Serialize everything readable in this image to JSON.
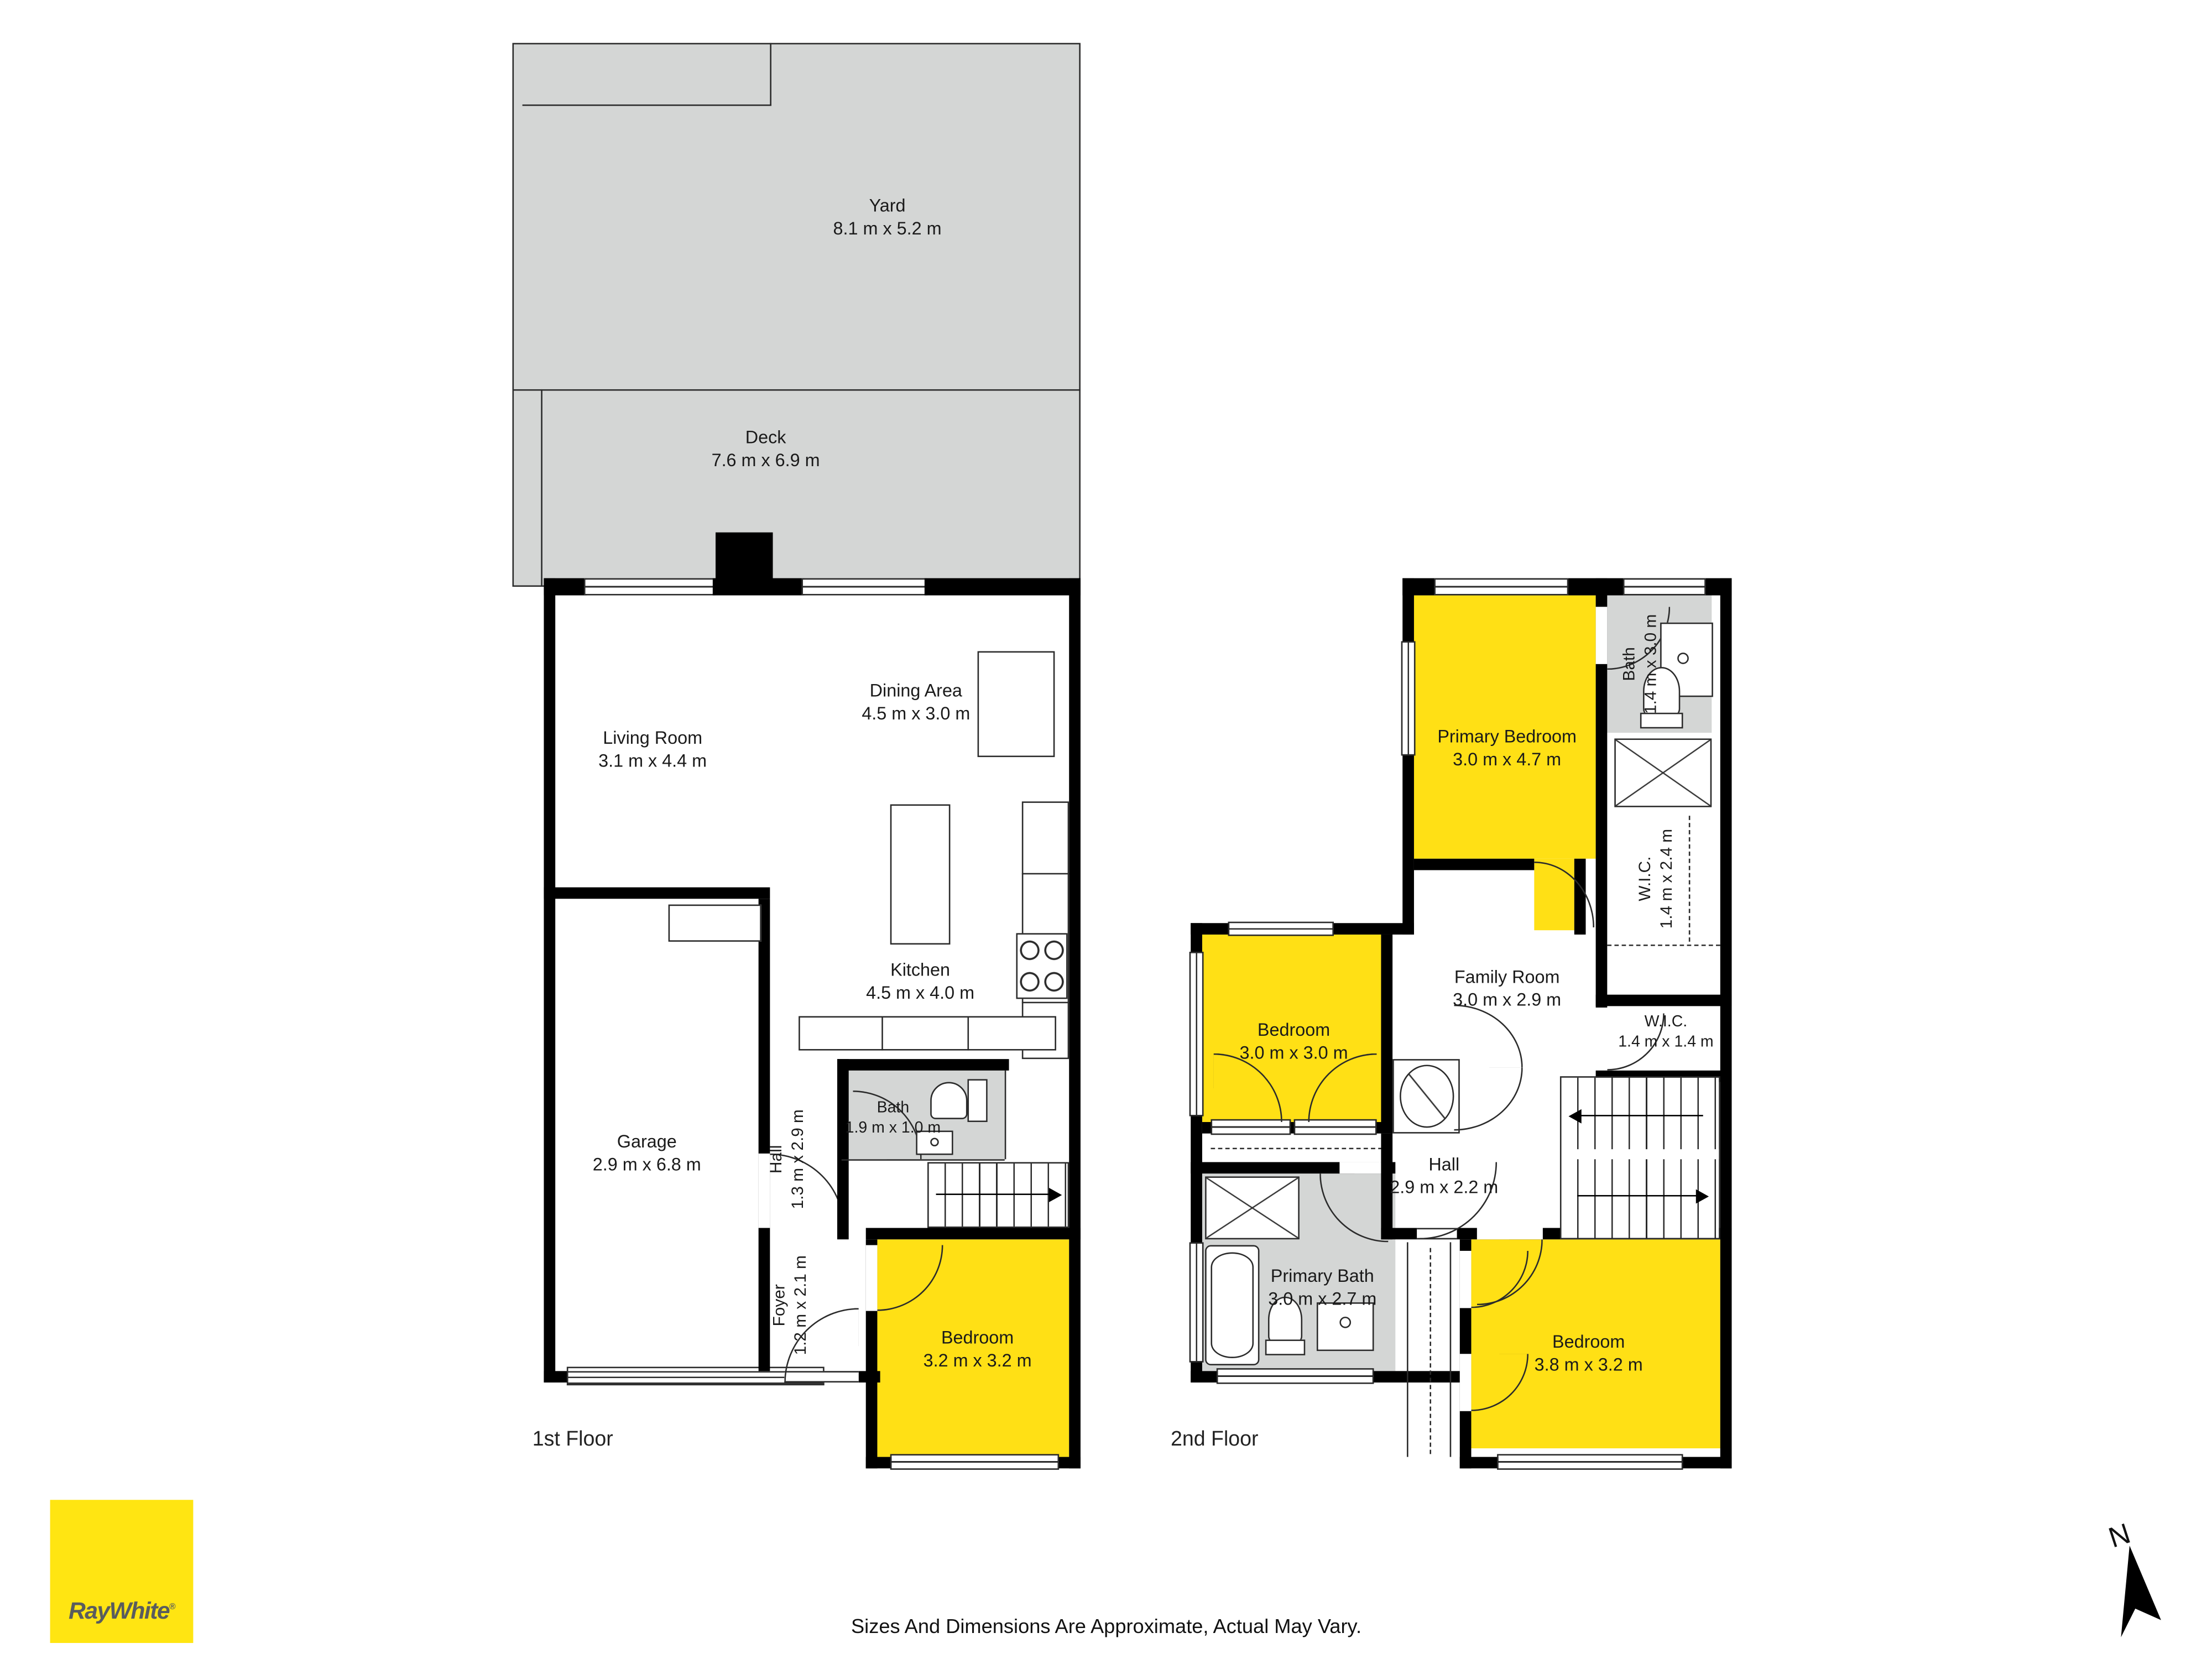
{
  "floors": [
    {
      "label": "1st Floor",
      "rooms": [
        {
          "name": "Yard",
          "dims": "8.1 m x 5.2 m"
        },
        {
          "name": "Deck",
          "dims": "7.6 m x 6.9 m"
        },
        {
          "name": "Living Room",
          "dims": "3.1 m x 4.4 m"
        },
        {
          "name": "Dining Area",
          "dims": "4.5 m x 3.0 m"
        },
        {
          "name": "Kitchen",
          "dims": "4.5 m x 4.0 m"
        },
        {
          "name": "Garage",
          "dims": "2.9 m x 6.8 m"
        },
        {
          "name": "Hall",
          "dims": "1.3 m x 2.9 m"
        },
        {
          "name": "Bath",
          "dims": "1.9 m x 1.0 m"
        },
        {
          "name": "Foyer",
          "dims": "1.2 m x 2.1 m"
        },
        {
          "name": "Bedroom",
          "dims": "3.2 m x 3.2 m"
        }
      ]
    },
    {
      "label": "2nd Floor",
      "rooms": [
        {
          "name": "Primary Bedroom",
          "dims": "3.0 m x 4.7 m"
        },
        {
          "name": "Bath",
          "dims": "1.4 m x 3.0 m"
        },
        {
          "name": "W.I.C.",
          "dims": "1.4 m x 2.4 m"
        },
        {
          "name": "Family Room",
          "dims": "3.0 m x 2.9 m"
        },
        {
          "name": "Bedroom",
          "dims": "3.0 m x 3.0 m"
        },
        {
          "name": "Hall",
          "dims": "2.9 m x 2.2 m"
        },
        {
          "name": "W.I.C.",
          "dims": "1.4 m x 1.4 m"
        },
        {
          "name": "Primary Bath",
          "dims": "3.0 m x 2.7 m"
        },
        {
          "name": "Bedroom",
          "dims": "3.8 m x 3.2 m"
        }
      ]
    }
  ],
  "branding": {
    "logo_text": "RayWhite",
    "registered": "®"
  },
  "disclaimer": "Sizes And Dimensions Are Approximate, Actual May Vary.",
  "compass": {
    "label": "N"
  },
  "colors": {
    "room_highlight": "#FFE015",
    "outdoor_gray": "#D4D6D5",
    "logo_yellow": "#FFE512",
    "logo_text": "#595C5E",
    "wall": "#000000"
  }
}
